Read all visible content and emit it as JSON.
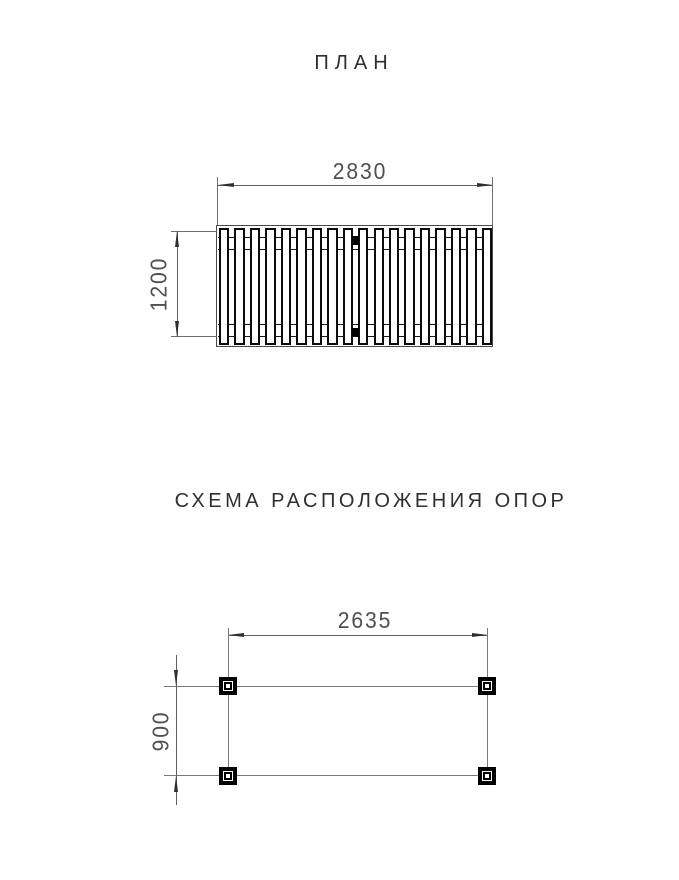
{
  "plan": {
    "title": "ПЛАН",
    "width_dim": {
      "value": "2830"
    },
    "depth_dim": {
      "value": "1200"
    },
    "slat_count": 18,
    "fixings": [
      {
        "position": "top-center"
      },
      {
        "position": "bottom-center"
      }
    ]
  },
  "supports": {
    "title": "СХЕМА РАСПОЛОЖЕНИЯ ОПОР",
    "width_dim": {
      "value": "2635"
    },
    "depth_dim": {
      "value": "900"
    },
    "post_count": 4,
    "posts": [
      {
        "position": "top-left"
      },
      {
        "position": "top-right"
      },
      {
        "position": "bottom-left"
      },
      {
        "position": "bottom-right"
      }
    ]
  },
  "colors": {
    "background": "#ffffff",
    "heavy_line": "#0c0c0c",
    "thin_line": "#6f6f6f",
    "dimension_text": "#4f4f4f",
    "title_text": "#2f2f2f"
  }
}
